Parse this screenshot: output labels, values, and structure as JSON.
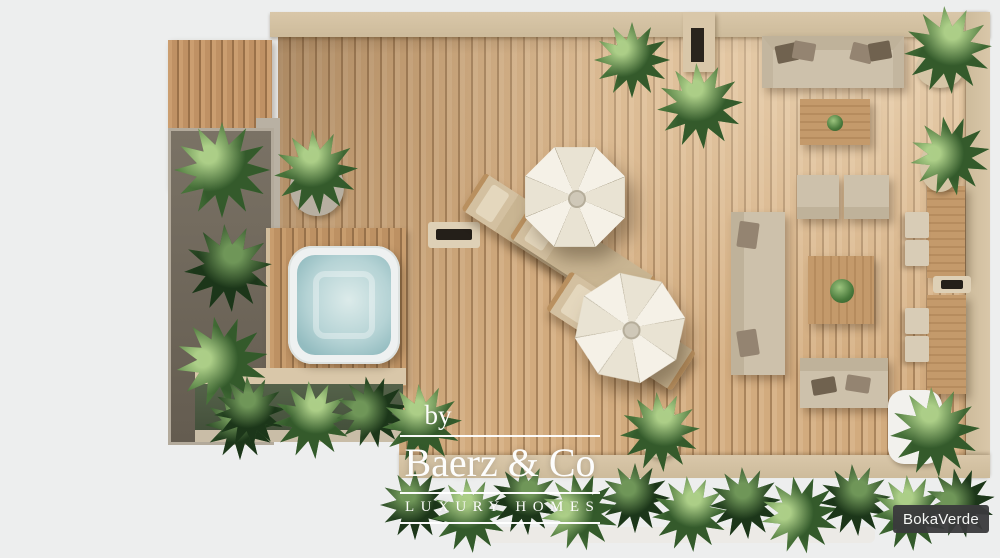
{
  "watermark": {
    "prefix": "by",
    "brand": "Baerz & Co",
    "tagline": "LUXURY HOMES"
  },
  "brand_badge": {
    "label": "BokaVerde"
  },
  "palette": {
    "background": "#edeeee",
    "deck_wood": "#d8b48a",
    "deck_gap": "#a9845c",
    "trim": "#d9c7a9",
    "cushion": "#cdc1ab",
    "foliage_light": "#5e8c49",
    "foliage_dark": "#2f5528",
    "hot_tub_water": "#b5d3d5",
    "badge_bg": "#3a3a3c"
  }
}
